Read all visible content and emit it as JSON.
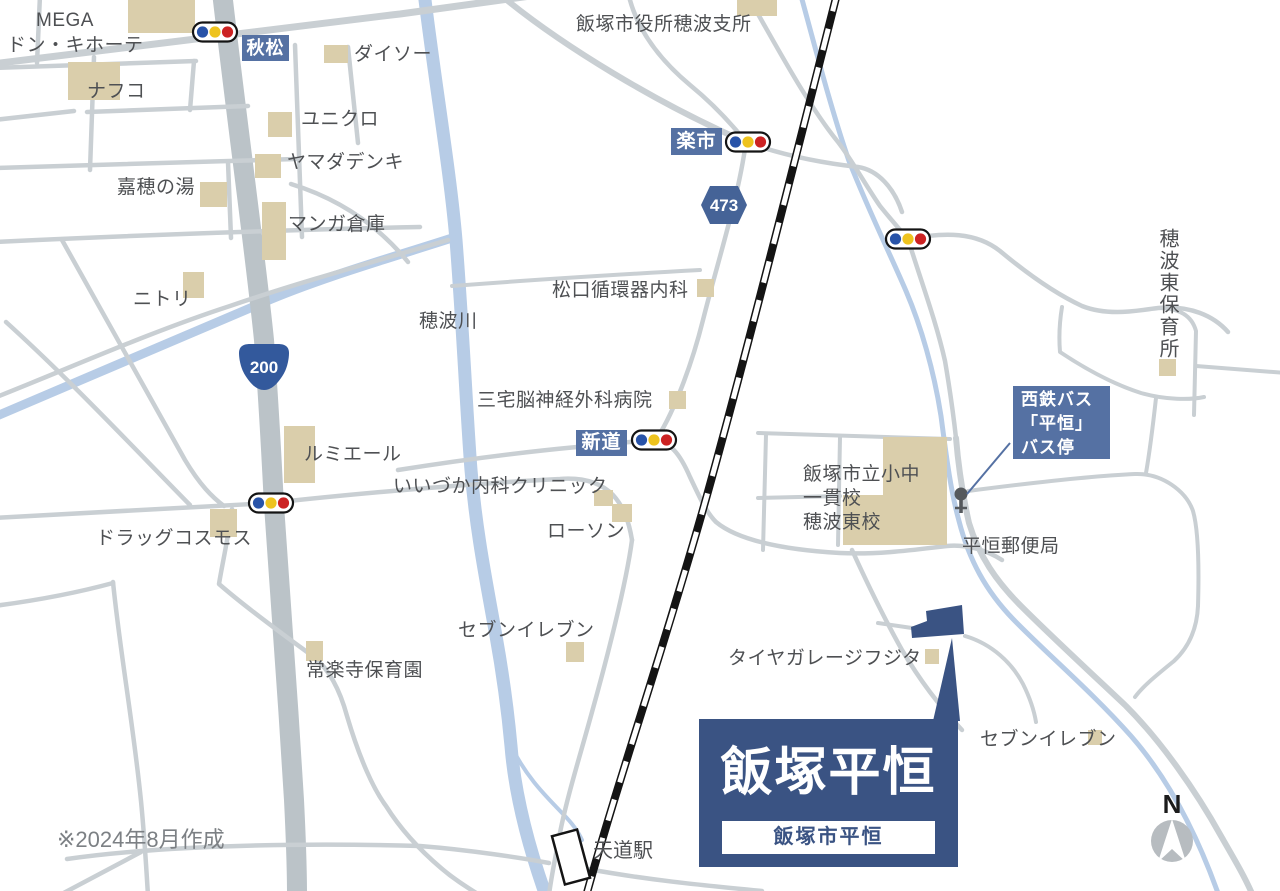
{
  "map": {
    "note": "※2024年8月作成",
    "compass": {
      "label": "N",
      "x": 1172,
      "y": 841
    },
    "station": {
      "name": "天道駅",
      "x": 571,
      "y": 857
    },
    "callout": {
      "title": "飯塚平恒",
      "subtitle": "飯塚市平恒"
    },
    "tags": [
      {
        "id": "akimatsu",
        "text": "秋松"
      },
      {
        "id": "rakuichi",
        "text": "楽市"
      },
      {
        "id": "shindo",
        "text": "新道"
      }
    ],
    "bus_tag": {
      "lines": [
        "西鉄バス",
        "「平恒」",
        "バス停"
      ]
    },
    "vertical_label": "穂波東保育所",
    "route_shields": [
      {
        "kind": "national-route-200",
        "number": "200",
        "x": 264,
        "y": 367
      },
      {
        "kind": "prefectural-route-473",
        "number": "473",
        "x": 724,
        "y": 205
      }
    ],
    "traffic_lights": [
      {
        "x": 215,
        "y": 32
      },
      {
        "x": 748,
        "y": 142
      },
      {
        "x": 908,
        "y": 239
      },
      {
        "x": 654,
        "y": 440
      },
      {
        "x": 271,
        "y": 503
      }
    ],
    "bus_stop_icon": {
      "x": 961,
      "y": 494
    },
    "labels": [
      {
        "id": "mega",
        "text": "MEGA",
        "x": 36,
        "y": 10
      },
      {
        "id": "don-quijote",
        "text": "ドン・キホーテ",
        "x": 7,
        "y": 35
      },
      {
        "id": "nafco",
        "text": "ナフコ",
        "x": 87,
        "y": 81
      },
      {
        "id": "daiso",
        "text": "ダイソー",
        "x": 354,
        "y": 44
      },
      {
        "id": "uniqlo",
        "text": "ユニクロ",
        "x": 301,
        "y": 109
      },
      {
        "id": "yamada-denki",
        "text": "ヤマダデンキ",
        "x": 287,
        "y": 152
      },
      {
        "id": "kaho-no-yu",
        "text": "嘉穂の湯",
        "x": 117,
        "y": 177
      },
      {
        "id": "manga-souko",
        "text": "マンガ倉庫",
        "x": 288,
        "y": 214
      },
      {
        "id": "nitori",
        "text": "ニトリ",
        "x": 133,
        "y": 289
      },
      {
        "id": "city-hall-branch",
        "text": "飯塚市役所穂波支所",
        "x": 576,
        "y": 14
      },
      {
        "id": "matsuguchi-clinic",
        "text": "松口循環器内科",
        "x": 552,
        "y": 280
      },
      {
        "id": "honami-river",
        "text": "穂波川",
        "x": 419,
        "y": 311
      },
      {
        "id": "miyake-hospital",
        "text": "三宅脳神経外科病院",
        "x": 477,
        "y": 390
      },
      {
        "id": "lumiere",
        "text": "ルミエール",
        "x": 304,
        "y": 444
      },
      {
        "id": "iizuka-clinic",
        "text": "いいづか内科クリニック",
        "x": 393,
        "y": 476
      },
      {
        "id": "drug-cosmos",
        "text": "ドラッグコスモス",
        "x": 96,
        "y": 528
      },
      {
        "id": "lawson",
        "text": "ローソン",
        "x": 547,
        "y": 521
      },
      {
        "id": "seven-eleven-center",
        "text": "セブンイレブン",
        "x": 458,
        "y": 620
      },
      {
        "id": "joraku-nursery",
        "text": "常楽寺保育園",
        "x": 306,
        "y": 660
      },
      {
        "id": "tire-garage-fujita",
        "text": "タイヤガレージフジタ",
        "x": 728,
        "y": 648
      },
      {
        "id": "seven-eleven-east",
        "text": "セブンイレブン",
        "x": 980,
        "y": 729
      },
      {
        "id": "post-office",
        "text": "平恒郵便局",
        "x": 962,
        "y": 536
      },
      {
        "id": "honami-east-school",
        "text": "飯塚市立小中\n一貫校\n穂波東校",
        "x": 803,
        "y": 463,
        "lh": 24
      }
    ],
    "colors": {
      "road": "#C9CFD3",
      "main_road": "#BBC3C8",
      "river": "#B7CCE6",
      "building": "#DACEAB",
      "tag_bg": "#5571A3",
      "callout_bg": "#3A5383",
      "rail": "#141414",
      "text": "#4E5053",
      "note_text": "#7C8084",
      "shield_blue": "#33599C",
      "tl_blue": "#2853A8",
      "tl_yellow": "#EEC31E",
      "tl_red": "#CC2222",
      "bus_icon": "#55595D",
      "compass_gray": "#B7BCC0"
    }
  }
}
